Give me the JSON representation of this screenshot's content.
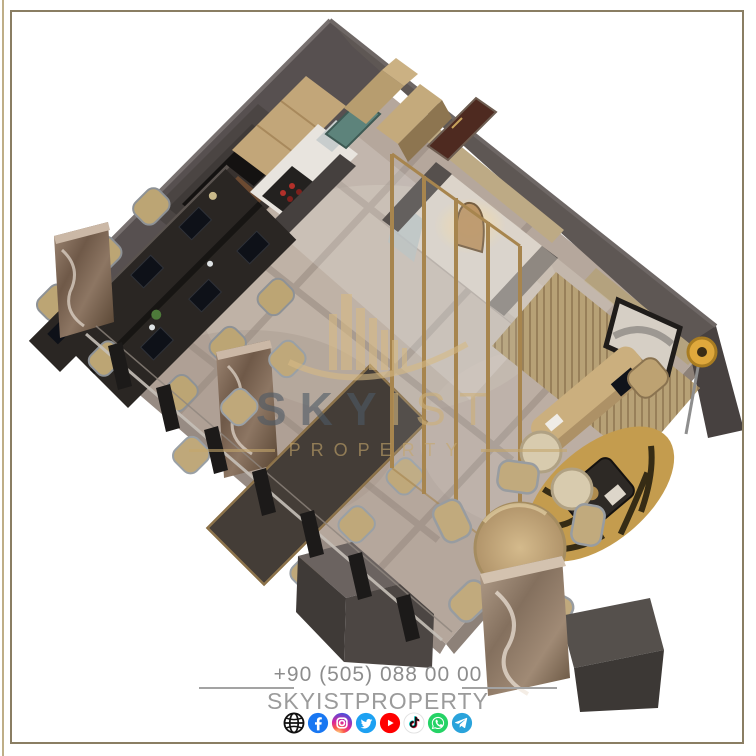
{
  "image": {
    "kind": "3d-office-floorplan-render",
    "background": "#ffffff",
    "frame_color": "#8a7e63"
  },
  "watermark": {
    "brand_primary": "SKY",
    "brand_secondary": "IST",
    "subtitle": "PROPERTY",
    "gold_color": "#c5a76c",
    "dark_color": "#4d5a66"
  },
  "footer": {
    "phone": "+90 (505) 088 00 00",
    "handle": "SKYISTPROPERTY",
    "text_color": "#9b9b9b"
  },
  "social": {
    "icons": [
      {
        "name": "website",
        "color": "#111111"
      },
      {
        "name": "facebook",
        "color": "#1877f2"
      },
      {
        "name": "instagram",
        "color": "#d6249f"
      },
      {
        "name": "twitter",
        "color": "#1da1f2"
      },
      {
        "name": "youtube",
        "color": "#ff0000"
      },
      {
        "name": "tiktok",
        "color": "#111111"
      },
      {
        "name": "whatsapp",
        "color": "#25d366"
      },
      {
        "name": "telegram",
        "color": "#2aa3db"
      }
    ]
  },
  "scene_palette": {
    "wall_dark": "#575050",
    "floor_marble": "#b5a79c",
    "wood_tan": "#c2a679",
    "gold_accent": "#a7854e",
    "marble_column": "#7c6454",
    "desk_black": "#2a2623",
    "chair_tan": "#bfa87a",
    "elevator_door_teal": "#5d837b",
    "entry_door_brown": "#4e2a20"
  }
}
